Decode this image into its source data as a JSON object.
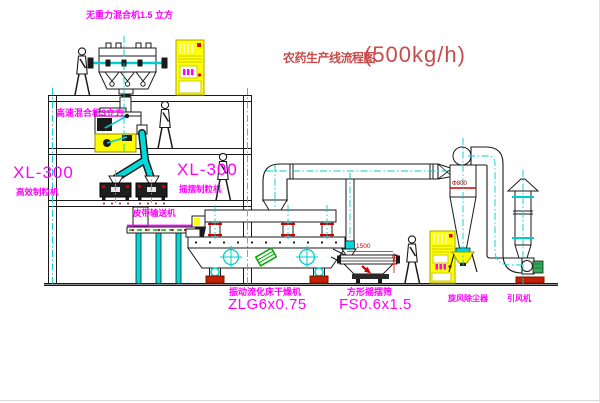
{
  "title": {
    "name": "农药生产线流程图",
    "capacity": "(500kg/h)"
  },
  "equipment_labels": {
    "gravity_mixer": "无重力混合机1.5 立方",
    "high_speed_mixer": "高速混合机3立方",
    "granulator_left": {
      "model": "XL-300",
      "name": "高效制粒机"
    },
    "granulator_mid": {
      "model": "XL-300",
      "name": "摇摆制粒机"
    },
    "belt_conveyor": "皮带输送机",
    "dryer": {
      "name": "振动流化床干燥机",
      "model": "ZLG6x0.75"
    },
    "sieve": {
      "name": "方形摇摆筛",
      "model": "FS0.6x1.5"
    },
    "cyclone": "旋风除尘器",
    "fan": "引风机"
  },
  "dimensions": {
    "sieve_length": "1500",
    "sieve_height": "541",
    "duct_diameter": "Φ800"
  },
  "colors": {
    "label_magenta": "#FF00FF",
    "title_red": "#C84B4B",
    "line_black": "#1A1A1A",
    "centerline_cyan": "#00CDCD",
    "machine_yellow": "#FFFF00",
    "accent_red": "#D00000",
    "accent_green": "#00AA00"
  }
}
